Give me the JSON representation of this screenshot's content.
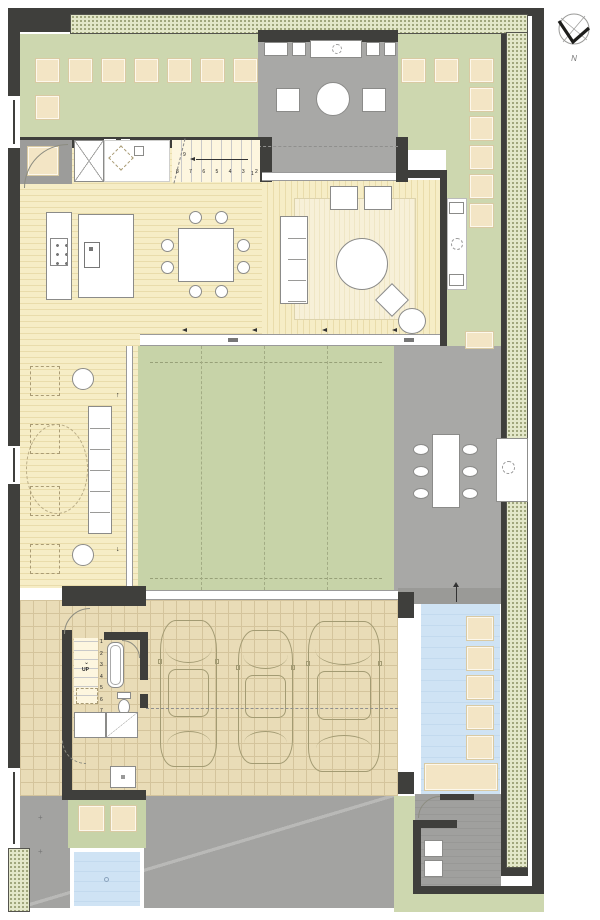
{
  "compass": {
    "label": "N"
  },
  "stairs_main": {
    "run_numbers": "8 7 6 5 4 3 2",
    "first_step": "1",
    "top_step": "9"
  },
  "stairs_garage": {
    "label": "UP",
    "steps": [
      "1",
      "2",
      "3",
      "4",
      "5",
      "6",
      "7"
    ]
  },
  "colors": {
    "wall": "#3f3f3c",
    "fl": "#8b8b89",
    "dl": "#a99b74",
    "hedgeFill": "#e3e7c9",
    "hedgeDot": "#8a9162",
    "hedgeLine": "#54544d",
    "garden": "#cdd7af",
    "court": "#c7d3a8",
    "wood": "#f6edc6",
    "woodline": "#e9dcab",
    "rug": "#f7f0d8",
    "rugline": "#efe6c5",
    "tgray": "#a8a8a6",
    "egray": "#9c9c9a",
    "bgray": "#9a9a97",
    "ugray": "#9f9f9d",
    "dgray": "#a3a3a1",
    "tile": "#e9dcb7",
    "tileline": "#d4c49c",
    "stone": "#f3e5c5",
    "pool": "#cfe3f4",
    "carline": "#a39b73",
    "glassline": "#9a9a9a"
  }
}
